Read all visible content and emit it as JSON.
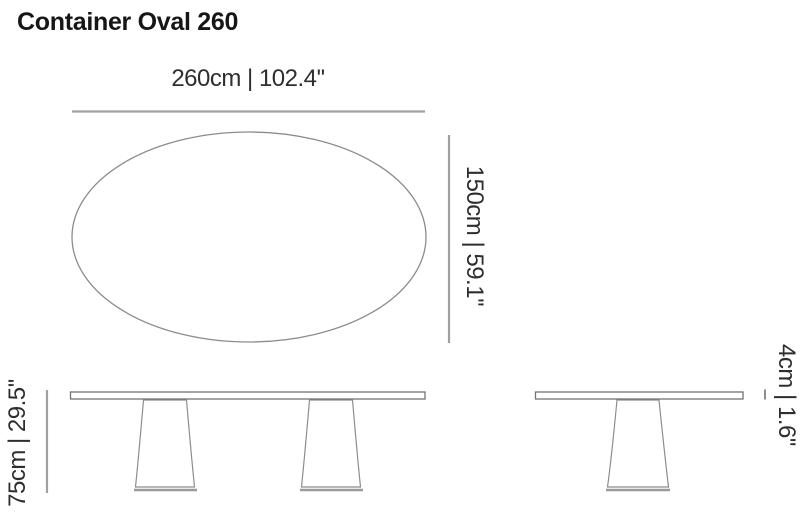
{
  "page": {
    "title": "Container Oval 260"
  },
  "colors": {
    "background": "#ffffff",
    "title_text": "#161616",
    "dimension_text": "#2e2e2e",
    "dimension_line": "#a0a0a0",
    "drawing_outline": "#8c8c8c"
  },
  "views": {
    "top": {
      "width_label": "260cm | 102.4''",
      "depth_label": "150cm | 59.1''"
    },
    "front": {
      "height_label": "75cm | 29.5''"
    },
    "side": {
      "thickness_label": "4cm | 1.6''"
    }
  }
}
